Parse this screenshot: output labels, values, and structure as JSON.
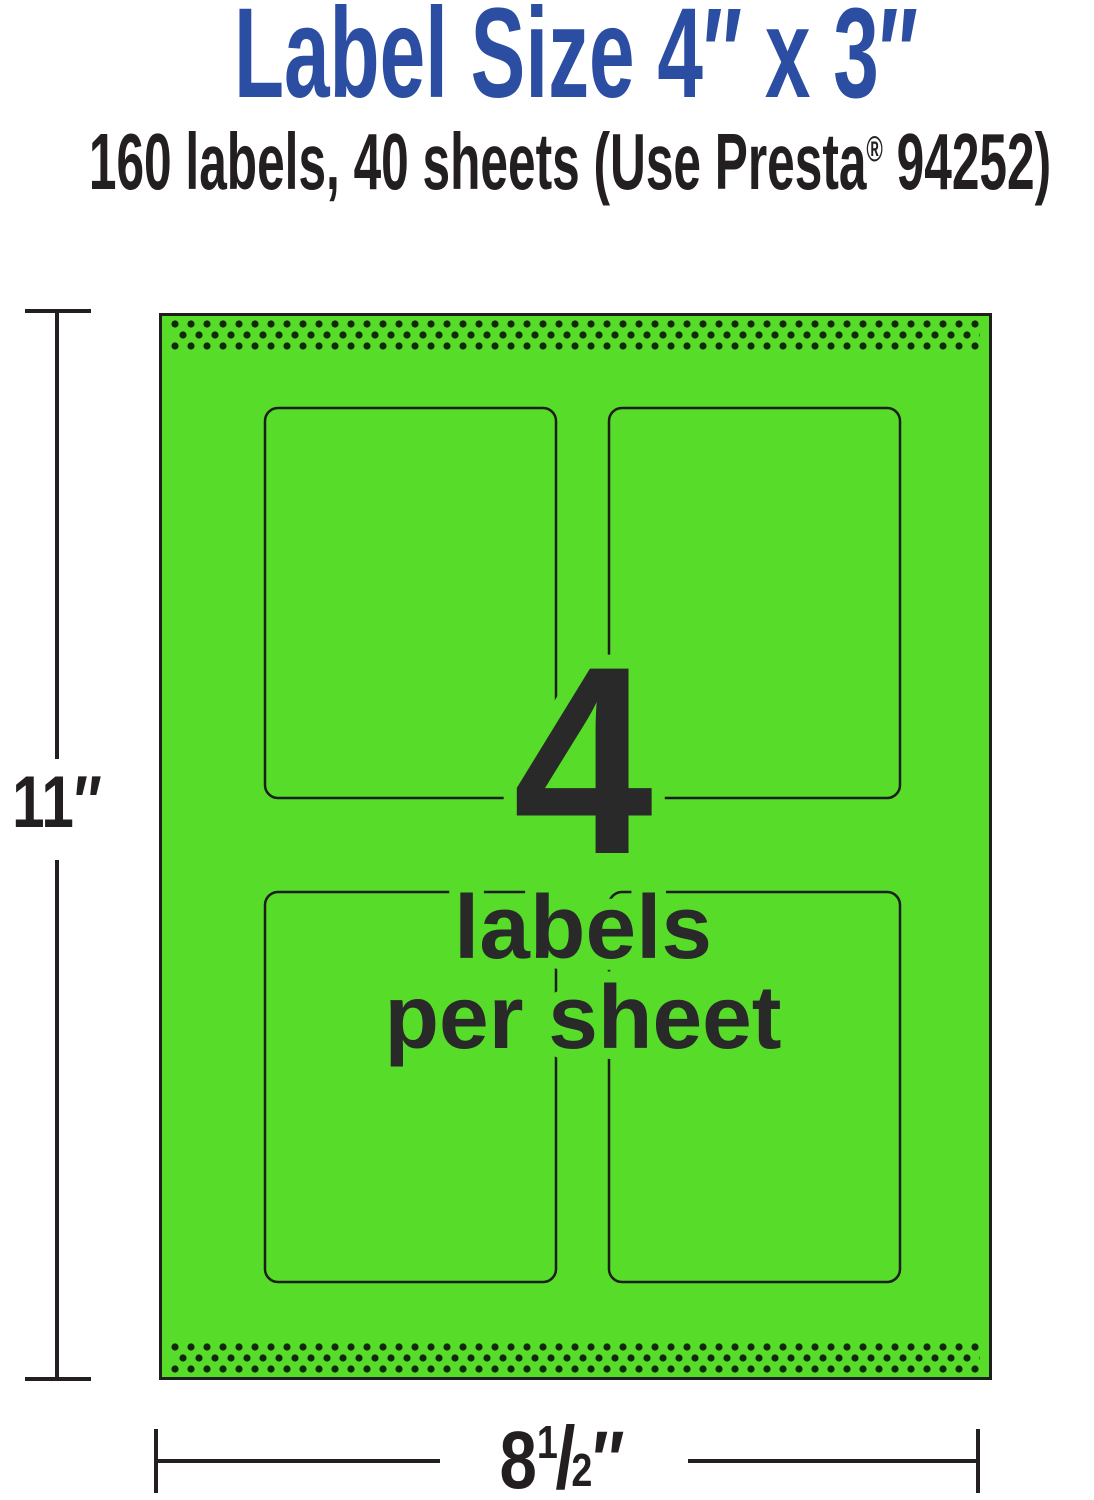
{
  "header": {
    "title": "Label Size 4″ x 3″",
    "subtitle_before": "160 labels, 40 sheets (Use Presta",
    "subtitle_reg_mark": "®",
    "subtitle_after": " 94252)"
  },
  "sheet": {
    "labels_per_sheet_number": "4",
    "caption_line1": "labels",
    "caption_line2": "per sheet",
    "label_outline_count": 4,
    "perforation_strips": [
      "top",
      "bottom"
    ]
  },
  "dimensions": {
    "height": "11″",
    "width_whole": "8",
    "width_fraction_numerator": "1",
    "width_fraction_slash": "/",
    "width_fraction_denominator": "2",
    "width_unit": "″"
  },
  "colors": {
    "title_blue": "#2b4ea3",
    "paper_green": "#56dc29",
    "ink_dark": "#231f20",
    "outline_dark": "#1e1e1c",
    "perforation_dot": "#10290a"
  }
}
